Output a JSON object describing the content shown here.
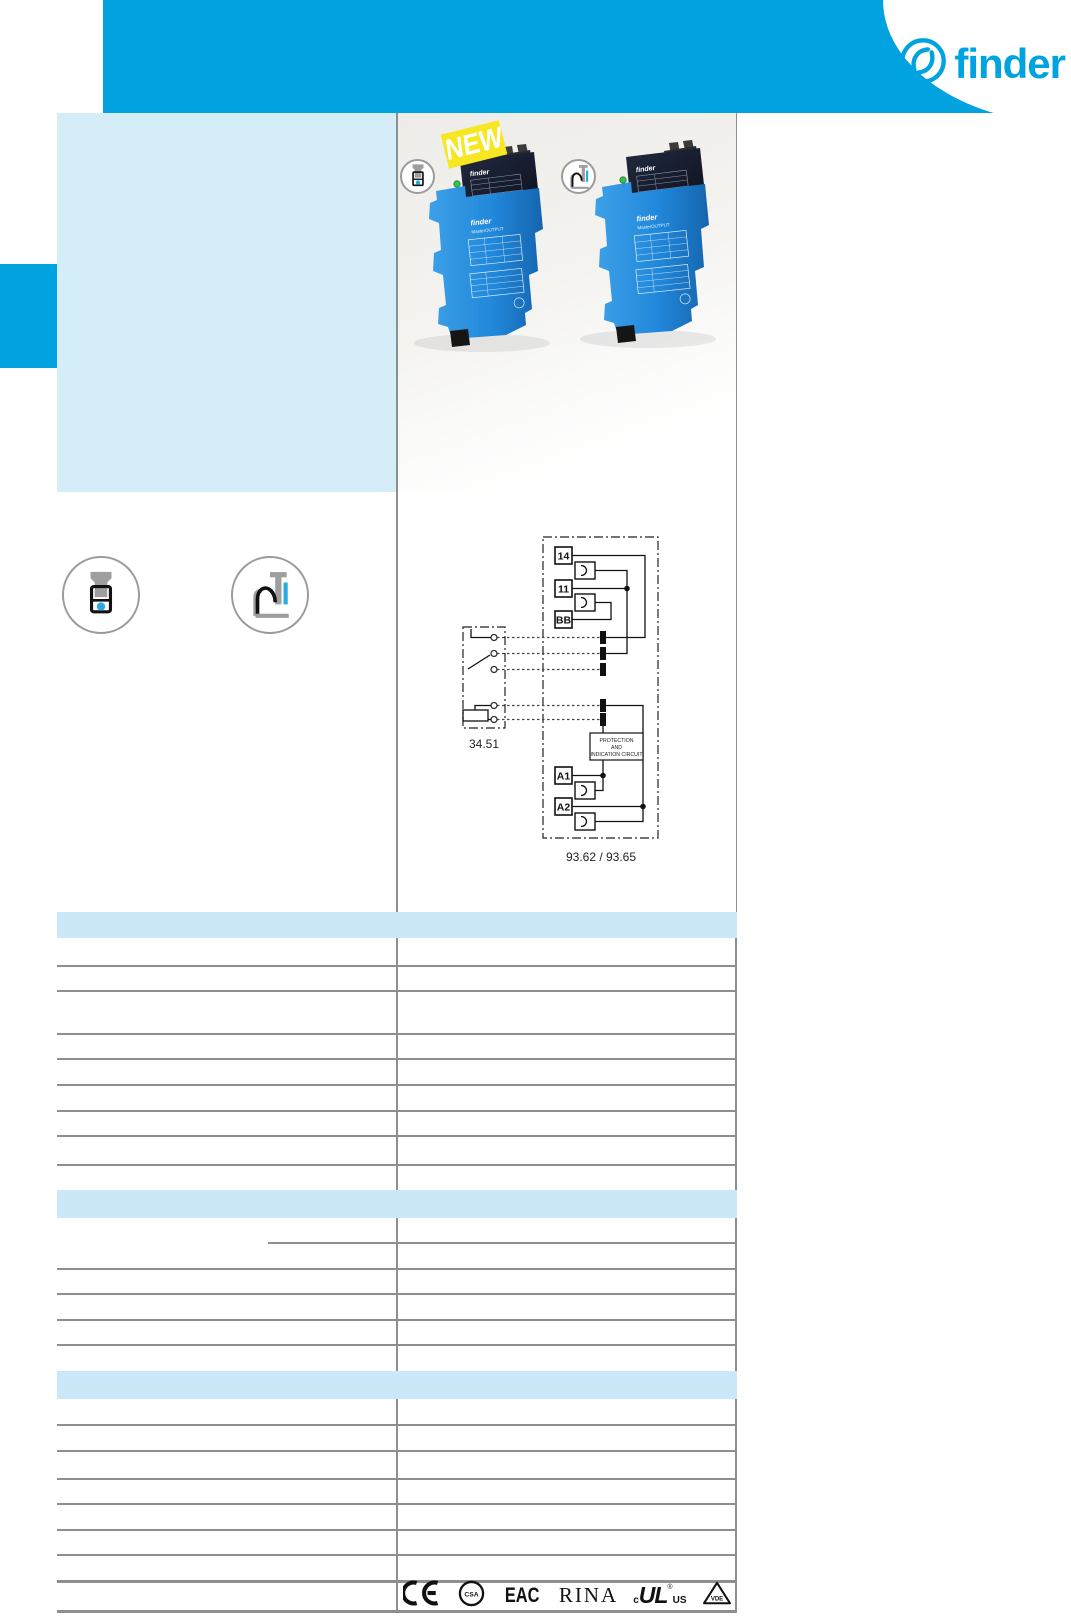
{
  "brand": {
    "logo_text": "finder",
    "accent": "#00A3E0"
  },
  "photo": {
    "badge_label": "NEW",
    "module_brand": "finder",
    "module_line": "MasterOUTPUT"
  },
  "mounting_icons": {
    "screw": "screw-terminal-icon",
    "push_in": "push-in-terminal-icon"
  },
  "diagram": {
    "terminals": [
      "14",
      "11",
      "BB",
      "A1",
      "A2"
    ],
    "socket_label": "34.51",
    "module_label": "93.62 / 93.65",
    "protection_lines": [
      "PROTECTION",
      "AND",
      "INDICATION CIRCUIT"
    ]
  },
  "certifications": {
    "ce": "CE",
    "csa": "CSA",
    "eac": "EAC",
    "rina": "RINA",
    "cul_c": "c",
    "cul_main": "UL",
    "cul_reg": "®",
    "cul_us": "US",
    "vde": "VDE"
  },
  "colors": {
    "accent": "#00A3E0",
    "feature_panel": "#D5ECF9",
    "section_band": "#CBE8F8",
    "rule_gray": "#8E8E8E",
    "badge_yellow": "#F7E622",
    "relay_blue": "#2188DB",
    "relay_navy": "#161B2C",
    "led_green": "#39C14F"
  }
}
